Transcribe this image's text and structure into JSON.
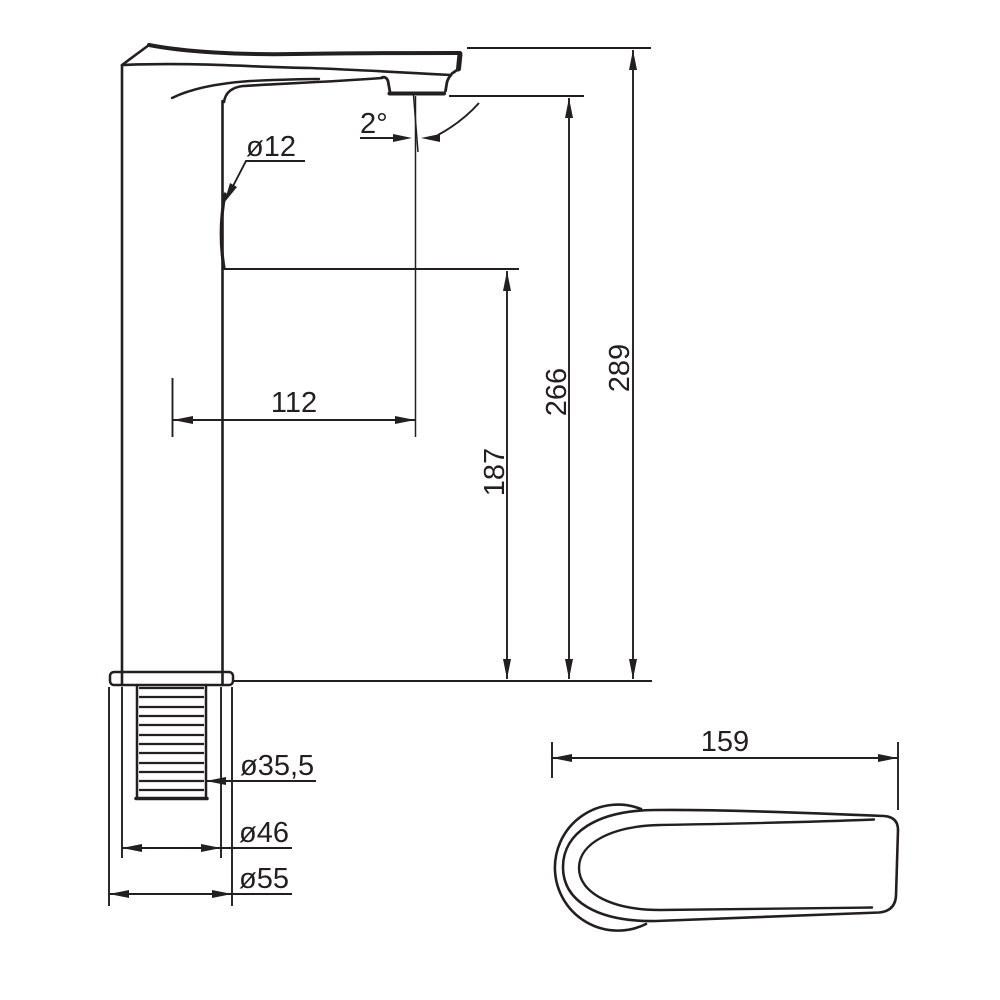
{
  "colors": {
    "line": "#231f20",
    "background": "#ffffff"
  },
  "labels": {
    "angle": "2°",
    "dia_spout": "ø12",
    "reach": "112",
    "h_mid": "187",
    "h_spout": "266",
    "h_total": "289",
    "dia_thread": "ø35,5",
    "dia_body": "ø46",
    "dia_base": "ø55",
    "handle_length": "159"
  }
}
